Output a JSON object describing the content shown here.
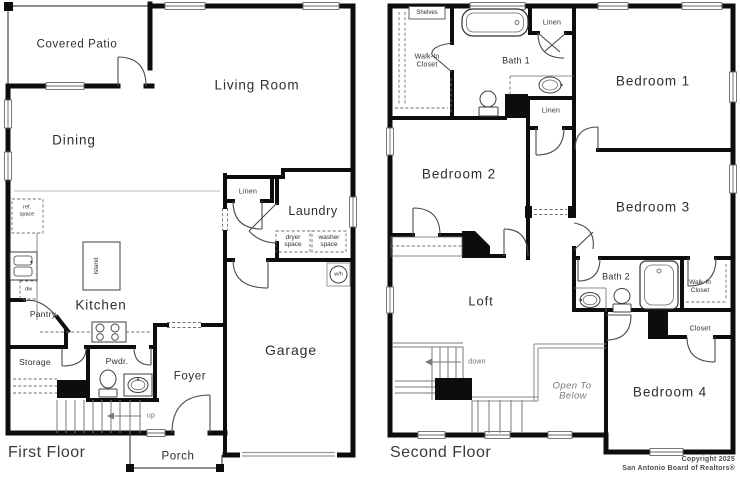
{
  "colors": {
    "wall": "#0d0d0d",
    "thin_line": "#777777",
    "label_text": "#2e2e2e",
    "muted_text": "#6f6f6f",
    "background": "#ffffff"
  },
  "first_floor": {
    "title": "First Floor",
    "rooms": {
      "covered_patio": "Covered Patio",
      "living_room": "Living Room",
      "dining": "Dining",
      "kitchen": "Kitchen",
      "island": "Island",
      "pantry": "Pantry",
      "storage": "Storage",
      "powder": "Pwdr.",
      "foyer": "Foyer",
      "laundry": "Laundry",
      "linen": "Linen",
      "garage": "Garage",
      "porch": "Porch"
    },
    "annotations": {
      "ref_line1": "ref.",
      "ref_line2": "space",
      "dishwasher": "dw",
      "dryer_line1": "dryer",
      "dryer_line2": "space",
      "washer_line1": "washer",
      "washer_line2": "space",
      "water_heater": "w/h",
      "stairs_up": "up"
    }
  },
  "second_floor": {
    "title": "Second Floor",
    "rooms": {
      "bedroom1": "Bedroom 1",
      "bedroom2": "Bedroom 2",
      "bedroom3": "Bedroom 3",
      "bedroom4": "Bedroom 4",
      "loft": "Loft",
      "bath1": "Bath 1",
      "bath2": "Bath 2",
      "walk_in_line1": "Walk-In",
      "walk_in_line2": "Closet",
      "closet": "Closet",
      "linen": "Linen"
    },
    "annotations": {
      "shelves": "Shelves",
      "stairs_down": "down",
      "open_to_below_line1": "Open To",
      "open_to_below_line2": "Below"
    }
  },
  "footer": {
    "copyright_line1": "Copyright 2025",
    "copyright_line2": "San Antonio Board of Realtors®"
  }
}
